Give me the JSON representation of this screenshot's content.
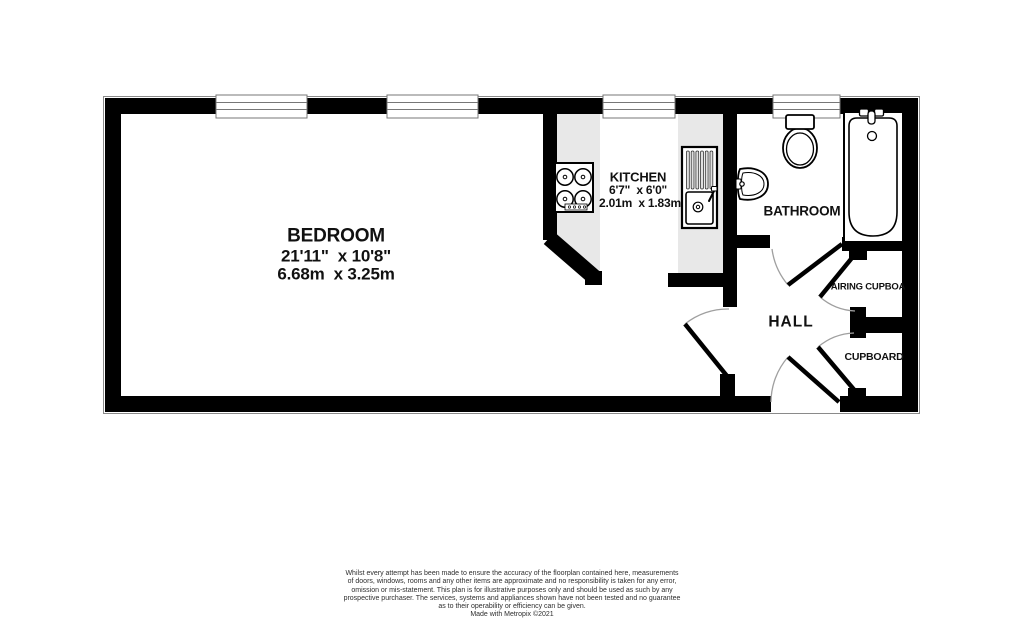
{
  "rooms": {
    "bedroom": {
      "name": "BEDROOM",
      "dimensions_imperial": "21'11\"  x 10'8\"",
      "dimensions_metric": "6.68m  x 3.25m"
    },
    "kitchen": {
      "name": "KITCHEN",
      "dimensions_imperial": "6'7\"  x 6'0\"",
      "dimensions_metric": "2.01m  x 1.83m"
    },
    "bathroom": {
      "name": "BATHROOM"
    },
    "hall": {
      "name": "HALL"
    },
    "airing_cupboard": {
      "name": "AIRING CUPBOA"
    },
    "cupboard": {
      "name": "CUPBOARD"
    }
  },
  "fixtures": {
    "stove": "stove-icon",
    "sink": "sink-drainer-icon",
    "toilet": "toilet-icon",
    "basin": "basin-icon",
    "bath": "bathtub-icon",
    "window_count": 4,
    "door_count": 5
  },
  "colors": {
    "wall": "#000000",
    "floor": "#ffffff",
    "counter": "#e8e8e8",
    "door_arc": "#9f9f9f",
    "window_border": "#777777"
  },
  "disclaimer": {
    "lines": [
      "Whilst every attempt has been made to ensure the accuracy of the floorplan contained here, measurements",
      "of doors, windows, rooms and any other items are approximate and no responsibility is taken for any error,",
      "omission or mis-statement. This plan is for illustrative purposes only and should be used as such by any",
      "prospective purchaser. The services, systems and appliances shown have not been tested and no guarantee",
      "as to their operability or efficiency can be given."
    ],
    "credit": "Made with Metropix ©2021"
  }
}
